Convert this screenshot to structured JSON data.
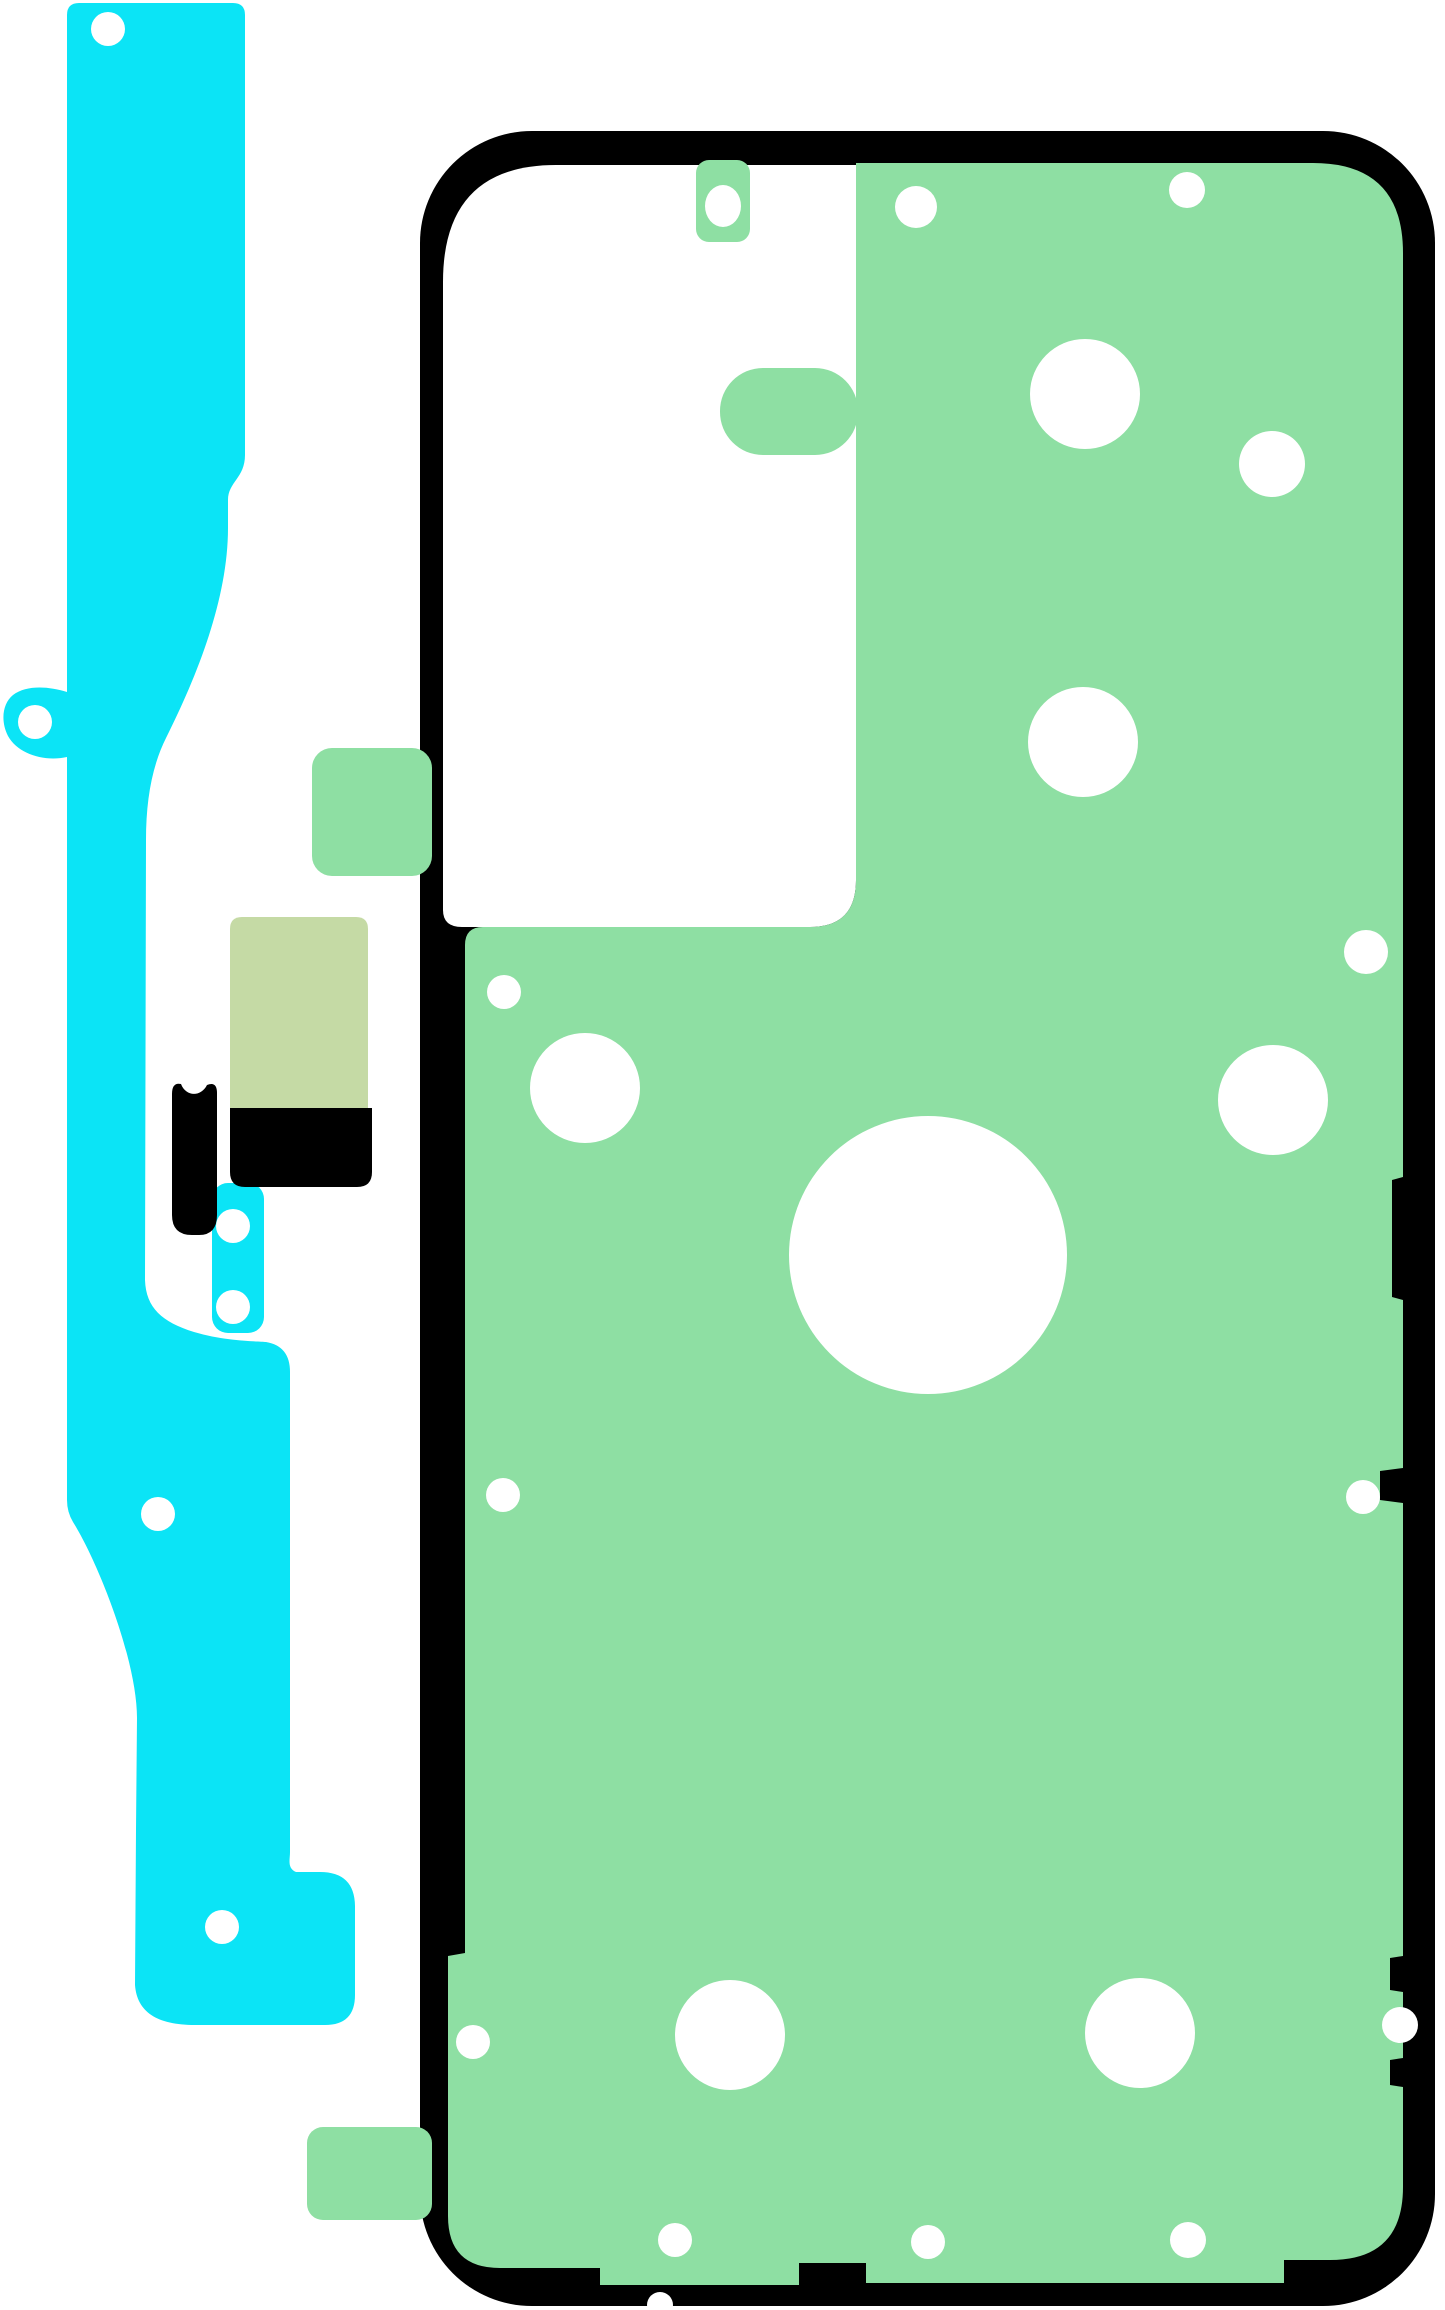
{
  "image": {
    "kind": "product-illustration",
    "subject": "smartphone back-cover adhesive rework kit (tape set)",
    "width_px": 1445,
    "height_px": 2310
  },
  "colors": {
    "background": "#ffffff",
    "cyan": "#0be4f6",
    "green": "#8edfa3",
    "sage": "#c5daa5",
    "black": "#000000",
    "hole": "#ffffff"
  },
  "parts": {
    "side_strip_label": "left cyan side adhesive strip",
    "small_strip_label": "small cyan adhesive piece",
    "sensor_pad_label": "sage sensor pad",
    "pad_backing_label": "black pad backing",
    "flex_piece_label": "black flex piece",
    "cover_sheet_label": "back-cover adhesive sheet with camera cutout"
  },
  "green_sheet_circles": [
    {
      "cx": 916,
      "cy": 207,
      "r": 21
    },
    {
      "cx": 1187,
      "cy": 190,
      "r": 18
    },
    {
      "cx": 1085,
      "cy": 394,
      "r": 55
    },
    {
      "cx": 1272,
      "cy": 464,
      "r": 33
    },
    {
      "cx": 1083,
      "cy": 742,
      "r": 55
    },
    {
      "cx": 1366,
      "cy": 952,
      "r": 22
    },
    {
      "cx": 504,
      "cy": 992,
      "r": 17
    },
    {
      "cx": 585,
      "cy": 1088,
      "r": 55
    },
    {
      "cx": 1273,
      "cy": 1100,
      "r": 55
    },
    {
      "cx": 928,
      "cy": 1255,
      "r": 139
    },
    {
      "cx": 503,
      "cy": 1495,
      "r": 17
    },
    {
      "cx": 1363,
      "cy": 1497,
      "r": 17
    },
    {
      "cx": 473,
      "cy": 2042,
      "r": 17
    },
    {
      "cx": 730,
      "cy": 2035,
      "r": 55
    },
    {
      "cx": 1140,
      "cy": 2033,
      "r": 55
    },
    {
      "cx": 1400,
      "cy": 2025,
      "r": 18
    },
    {
      "cx": 675,
      "cy": 2240,
      "r": 17
    },
    {
      "cx": 928,
      "cy": 2242,
      "r": 17
    },
    {
      "cx": 1188,
      "cy": 2240,
      "r": 18
    },
    {
      "cx": 660,
      "cy": 2305,
      "r": 13
    }
  ],
  "cyan_strip_holes": [
    {
      "cx": 108,
      "cy": 29,
      "r": 17
    },
    {
      "cx": 35,
      "cy": 722,
      "r": 17
    },
    {
      "cx": 158,
      "cy": 1514,
      "r": 17
    },
    {
      "cx": 222,
      "cy": 1927,
      "r": 17
    }
  ],
  "small_strip_holes": [
    {
      "cx": 233,
      "cy": 1226,
      "r": 17
    },
    {
      "cx": 233,
      "cy": 1307,
      "r": 17
    }
  ],
  "notch_tab_hole": {
    "cx": 723,
    "cy": 206,
    "rx": 18,
    "ry": 21
  }
}
